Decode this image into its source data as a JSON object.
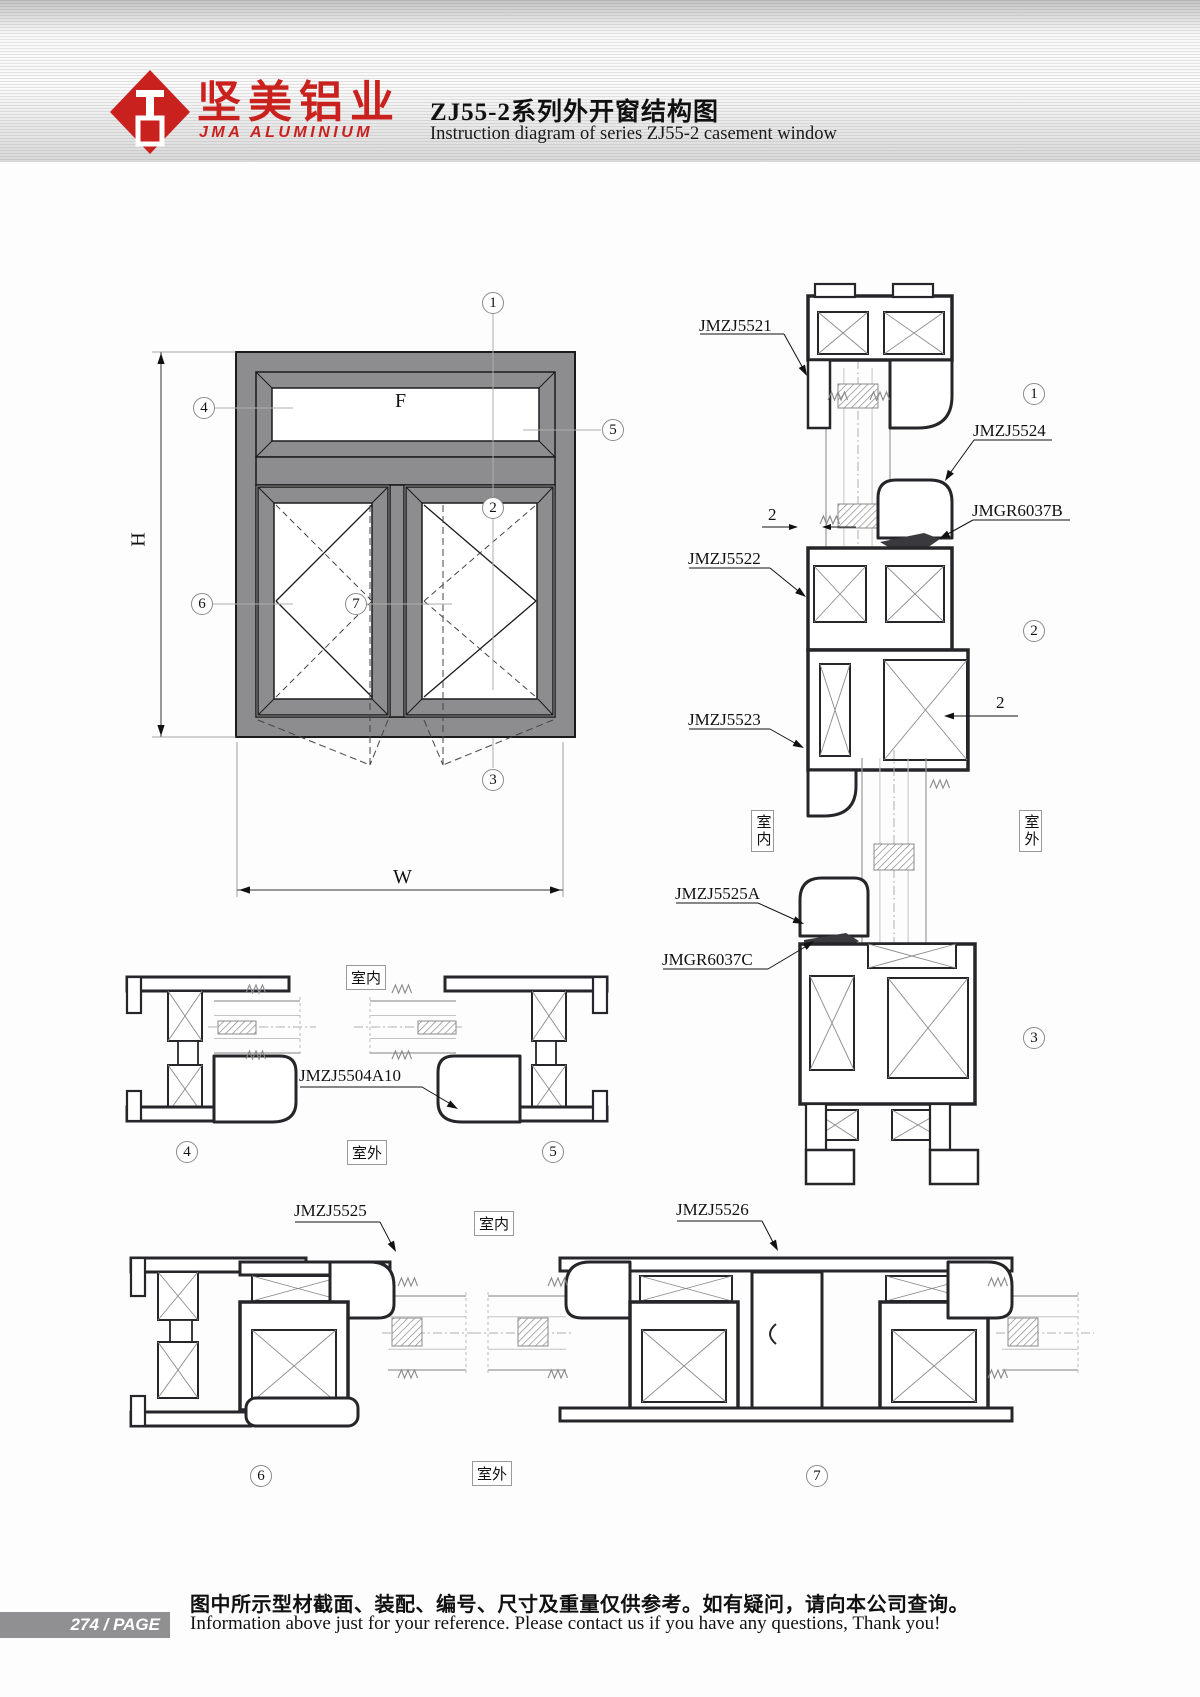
{
  "header": {
    "logo_text_cn": "坚美铝业",
    "logo_text_en": "JMA ALUMINIUM",
    "title_cn": "ZJ55-2系列外开窗结构图",
    "title_en": "Instruction diagram of series ZJ55-2 casement window"
  },
  "labels": {
    "indoor": "室内",
    "outdoor": "室外",
    "height_dim": "H",
    "width_dim": "W",
    "fixed_pane": "F",
    "gap_dim": "2"
  },
  "callouts": {
    "n1": "1",
    "n2": "2",
    "n3": "3",
    "n4": "4",
    "n5": "5",
    "n6": "6",
    "n7": "7"
  },
  "profiles": {
    "top_frame": "JMZJ5521",
    "transom_bead": "JMZJ5524",
    "gasket_b": "JMGR6037B",
    "transom": "JMZJ5522",
    "sash_top": "JMZJ5523",
    "sash_bottom": "JMZJ5525A",
    "gasket_c": "JMGR6037C",
    "side_sash": "JMZJ5504A10",
    "bottom_sash": "JMZJ5525",
    "mullion_section": "JMZJ5526"
  },
  "colors": {
    "accent_red": "#c9221e",
    "frame_gray": "#8d8d8f"
  },
  "footer": {
    "page_badge": "274 / PAGE",
    "note_cn": "图中所示型材截面、装配、编号、尺寸及重量仅供参考。如有疑问，请向本公司查询。",
    "note_en": "Information above just for your reference. Please contact us if you have any questions, Thank you!"
  }
}
